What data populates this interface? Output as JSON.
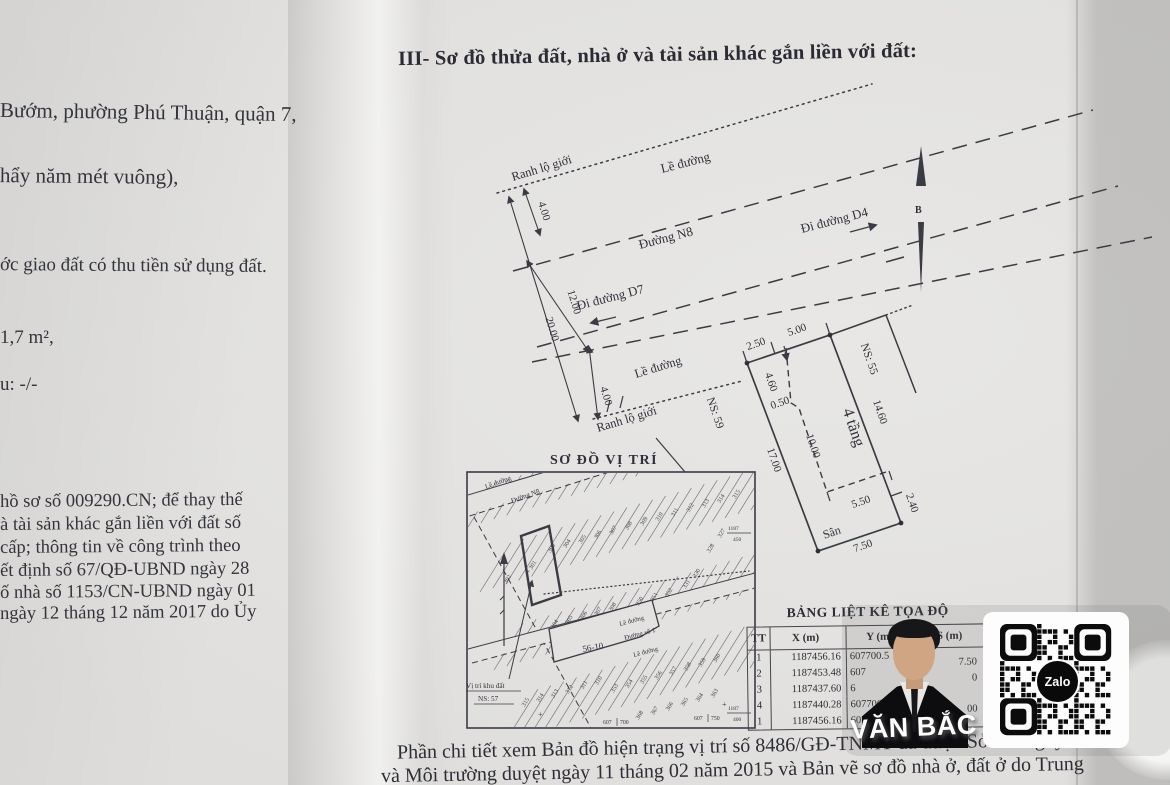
{
  "page": {
    "title": "III- Sơ đồ thửa đất, nhà ở và tài sản khác gắn liền với đất:",
    "left_lines": [
      "Bướm, phường Phú Thuận, quận 7,",
      "hẩy năm mét vuông),",
      "ớc giao đất có thu tiền sử dụng đất.",
      "1,7  m²,",
      "u: -/-",
      "hồ sơ số 009290.CN; để thay thế",
      "à tài sản khác gắn liền với đất số",
      "cấp; thông tin về công trình theo",
      "ết định số 67/QĐ-UBND ngày 28",
      "ố nhà số 1153/CN-UBND ngày 01",
      "ngày 12 tháng 12 năm 2017 do Ủy"
    ],
    "footer_lines": [
      "Phần chi tiết xem Bản đồ hiện trạng vị trí số 8486/GĐ-TNMT đã được Sở Tài nguyên",
      "và Môi trường duyệt ngày 11 tháng 02 năm 2015 và Bản vẽ sơ đồ nhà ở, đất ở do Trung"
    ]
  },
  "site_plan": {
    "ranh_top": "Ranh lộ giới",
    "le_top": "Lề đường",
    "road_n8": "Đường N8",
    "to_d4": "Đi đường D4",
    "to_d7": "Đi đường D7",
    "le_mid": "Lề đường",
    "ranh_bottom": "Ranh lộ giới",
    "dim_4_top": "4.00",
    "dim_12": "12.00",
    "dim_20": "20.00",
    "dim_4_bottom": "4.00",
    "north": "B"
  },
  "plot": {
    "dim_top_left": "2.50",
    "dim_top_right": "5.00",
    "neighbor_right": "NS: 55",
    "neighbor_left": "NS: 59",
    "dim_right": "14.60",
    "dim_right_end": "2.40",
    "dim_left": "17.00",
    "dim_house_len": "10.00",
    "dim_house_w": "4.60",
    "dim_jog": "0.50",
    "house": "4 tầng",
    "dim_yard": "5.50",
    "yard": "Sân",
    "dim_bottom": "7.50"
  },
  "location_map": {
    "title": "SƠ ĐỒ VỊ TRÍ",
    "sidewalk_top": "Lề đường",
    "road_n8": "Đường N8",
    "sidewalk_mid": "Lề đường",
    "road_1": "Đường số 1",
    "sidewalk_mid2": "Lề đường",
    "block": "56-10",
    "subject_line1": "Vị trí khu đất",
    "subject_line2": "NS: 57",
    "coords": {
      "b1a": "607",
      "b1b": "700",
      "b2a": "607",
      "b2b": "750",
      "r1a": "1187",
      "r1b": "450",
      "r2a": "1187",
      "r2b": "400"
    },
    "fans": [
      {
        "x": 553,
        "y": 549,
        "dx": 15.4,
        "dy": -4.5,
        "values": [
          "303",
          "304",
          "305",
          "306",
          "307",
          "308",
          "309",
          "310",
          "311",
          "312",
          "313",
          "314",
          "315"
        ]
      },
      {
        "x": 533,
        "y": 568,
        "dx": 13,
        "dy": -4,
        "values": [
          "+ 301"
        ]
      },
      {
        "x": 509,
        "y": 580,
        "dx": 13,
        "dy": -4,
        "values": [
          "302"
        ]
      },
      {
        "x": 723,
        "y": 534,
        "dx": -11,
        "dy": 15,
        "values": [
          "327",
          "328"
        ]
      },
      {
        "x": 556,
        "y": 625,
        "dx": 14.5,
        "dy": -4.3,
        "values": [
          "304",
          "305",
          "306",
          "307",
          "308"
        ]
      },
      {
        "x": 641,
        "y": 602,
        "dx": 14.6,
        "dy": -4.3,
        "values": [
          "350",
          "351",
          "352"
        ]
      },
      {
        "x": 688,
        "y": 585,
        "dx": 10,
        "dy": -11,
        "values": [
          "331",
          "330"
        ]
      },
      {
        "x": 527,
        "y": 703,
        "dx": 14.6,
        "dy": -4.3,
        "values": [
          "315",
          "314",
          "313",
          "312",
          "311",
          "310"
        ]
      },
      {
        "x": 616,
        "y": 689,
        "dx": 14.6,
        "dy": -4.3,
        "values": [
          "353",
          "354",
          "355",
          "356",
          "357",
          "358",
          "359",
          "360"
        ]
      },
      {
        "x": 641,
        "y": 716,
        "dx": 15,
        "dy": -4.4,
        "values": [
          "368",
          "367",
          "366",
          "365",
          "364",
          "363"
        ]
      }
    ]
  },
  "coord_table": {
    "title": "BẢNG LIỆT KÊ TỌA ĐỘ",
    "headers": [
      "TT",
      "X (m)",
      "Y (m)",
      "S (m)"
    ],
    "rows": [
      {
        "tt": "1",
        "x": "1187456.16",
        "y": "607700.5"
      },
      {
        "tt": "2",
        "x": "1187453.48",
        "y": "607"
      },
      {
        "tt": "3",
        "x": "1187437.60",
        "y": "6"
      },
      {
        "tt": "4",
        "x": "1187440.28",
        "y": "607706.60"
      },
      {
        "tt": "1",
        "x": "1187456.16",
        "y": "607"
      }
    ],
    "s_between": [
      "7.50",
      "0",
      "",
      "00"
    ]
  },
  "watermark": {
    "name": "VĂN BẮC",
    "qr_logo": "Zalo"
  },
  "colors": {
    "ink": "#30303a",
    "paper": "#e3e2e0",
    "accent_dark": "#0d0d10"
  }
}
